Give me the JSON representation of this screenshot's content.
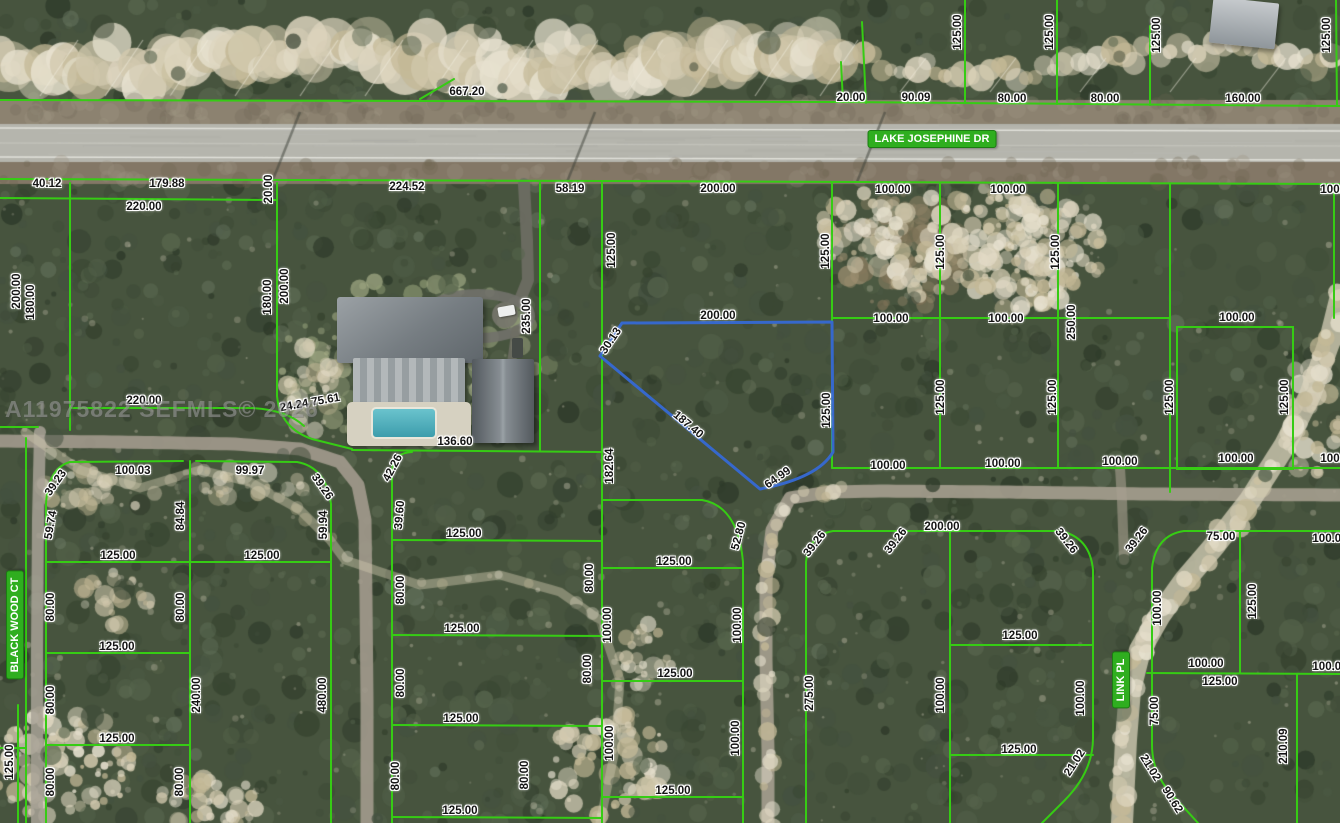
{
  "map": {
    "width": 1340,
    "height": 823,
    "description": "Aerial parcel map with lot dimension overlay",
    "watermark": {
      "text": "A11975822  SEFMLS© 2026"
    },
    "colors": {
      "parcel_line": "#36cc14",
      "highlight_parcel": "#3668cc",
      "street_label_bg": "#2fae1f",
      "street_label_text": "#ffffff",
      "dimension_text": "#141414"
    },
    "street_labels": [
      {
        "name": "LAKE JOSEPHINE DR",
        "x": 932,
        "y": 139,
        "r": 0
      },
      {
        "name": "BLACK WOOD CT",
        "x": 15,
        "y": 625,
        "r": -90
      },
      {
        "name": "LINK PL",
        "x": 1121,
        "y": 680,
        "r": -90
      }
    ],
    "highlighted_parcel": {
      "path": "M622,323 L832,322 L833,452 Q818,478 760,489 L600,356 Z",
      "dimensions": [
        "200.00",
        "125.00",
        "64.99",
        "187.40",
        "30.13"
      ]
    },
    "dimension_labels": [
      {
        "t": "667.20",
        "x": 467,
        "y": 92,
        "r": 0
      },
      {
        "t": "20.00",
        "x": 851,
        "y": 98,
        "r": 0
      },
      {
        "t": "90.09",
        "x": 916,
        "y": 98,
        "r": 0
      },
      {
        "t": "80.00",
        "x": 1012,
        "y": 99,
        "r": 0
      },
      {
        "t": "80.00",
        "x": 1105,
        "y": 99,
        "r": 0
      },
      {
        "t": "160.00",
        "x": 1243,
        "y": 99,
        "r": 0
      },
      {
        "t": "125.00",
        "x": 958,
        "y": 32,
        "r": -90
      },
      {
        "t": "125.00",
        "x": 1050,
        "y": 32,
        "r": -90
      },
      {
        "t": "125.00",
        "x": 1157,
        "y": 35,
        "r": -90
      },
      {
        "t": "125.00",
        "x": 1327,
        "y": 35,
        "r": -90
      },
      {
        "t": "40.12",
        "x": 47,
        "y": 184,
        "r": 0
      },
      {
        "t": "179.88",
        "x": 167,
        "y": 184,
        "r": 0
      },
      {
        "t": "224.52",
        "x": 407,
        "y": 187,
        "r": 0
      },
      {
        "t": "58.19",
        "x": 570,
        "y": 189,
        "r": 0
      },
      {
        "t": "200.00",
        "x": 718,
        "y": 189,
        "r": 0
      },
      {
        "t": "100.00",
        "x": 893,
        "y": 190,
        "r": 0
      },
      {
        "t": "100.00",
        "x": 1008,
        "y": 190,
        "r": 0
      },
      {
        "t": "100.00",
        "x": 1338,
        "y": 190,
        "r": 0
      },
      {
        "t": "220.00",
        "x": 144,
        "y": 207,
        "r": 0
      },
      {
        "t": "20.00",
        "x": 269,
        "y": 189,
        "r": -90
      },
      {
        "t": "200.00",
        "x": 17,
        "y": 291,
        "r": -90
      },
      {
        "t": "180.00",
        "x": 31,
        "y": 302,
        "r": -90
      },
      {
        "t": "180.00",
        "x": 268,
        "y": 297,
        "r": -90
      },
      {
        "t": "200.00",
        "x": 285,
        "y": 286,
        "r": -90
      },
      {
        "t": "235.00",
        "x": 527,
        "y": 316,
        "r": -90
      },
      {
        "t": "125.00",
        "x": 612,
        "y": 250,
        "r": -90
      },
      {
        "t": "125.00",
        "x": 826,
        "y": 251,
        "r": -90
      },
      {
        "t": "125.00",
        "x": 941,
        "y": 252,
        "r": -90
      },
      {
        "t": "125.00",
        "x": 1056,
        "y": 252,
        "r": -90
      },
      {
        "t": "200.00",
        "x": 718,
        "y": 316,
        "r": 0
      },
      {
        "t": "100.00",
        "x": 891,
        "y": 319,
        "r": 0
      },
      {
        "t": "100.00",
        "x": 1006,
        "y": 319,
        "r": 0
      },
      {
        "t": "100.00",
        "x": 1237,
        "y": 318,
        "r": 0
      },
      {
        "t": "250.00",
        "x": 1072,
        "y": 322,
        "r": -90
      },
      {
        "t": "30.13",
        "x": 611,
        "y": 341,
        "r": -56
      },
      {
        "t": "187.40",
        "x": 688,
        "y": 425,
        "r": 40
      },
      {
        "t": "64.99",
        "x": 778,
        "y": 478,
        "r": -35
      },
      {
        "t": "125.00",
        "x": 827,
        "y": 410,
        "r": -90
      },
      {
        "t": "125.00",
        "x": 941,
        "y": 397,
        "r": -90
      },
      {
        "t": "125.00",
        "x": 1053,
        "y": 397,
        "r": -90
      },
      {
        "t": "125.00",
        "x": 1170,
        "y": 397,
        "r": -90
      },
      {
        "t": "125.00",
        "x": 1285,
        "y": 397,
        "r": -90
      },
      {
        "t": "182.64",
        "x": 610,
        "y": 466,
        "r": -90
      },
      {
        "t": "220.00",
        "x": 144,
        "y": 401,
        "r": 0
      },
      {
        "t": "24.24 75.61",
        "x": 310,
        "y": 403,
        "r": -10
      },
      {
        "t": "136.60",
        "x": 455,
        "y": 442,
        "r": 0
      },
      {
        "t": "100.00",
        "x": 888,
        "y": 466,
        "r": 0
      },
      {
        "t": "100.00",
        "x": 1003,
        "y": 464,
        "r": 0
      },
      {
        "t": "100.00",
        "x": 1120,
        "y": 462,
        "r": 0
      },
      {
        "t": "100.00",
        "x": 1236,
        "y": 459,
        "r": 0
      },
      {
        "t": "100.00",
        "x": 1338,
        "y": 459,
        "r": 0
      },
      {
        "t": "100.03",
        "x": 133,
        "y": 471,
        "r": 0
      },
      {
        "t": "99.97",
        "x": 250,
        "y": 471,
        "r": 0
      },
      {
        "t": "39.23",
        "x": 56,
        "y": 483,
        "r": -55
      },
      {
        "t": "59.74",
        "x": 51,
        "y": 525,
        "r": -80
      },
      {
        "t": "84.84",
        "x": 181,
        "y": 516,
        "r": -90
      },
      {
        "t": "39.26",
        "x": 322,
        "y": 487,
        "r": 55
      },
      {
        "t": "59.94",
        "x": 324,
        "y": 525,
        "r": -90
      },
      {
        "t": "125.00",
        "x": 118,
        "y": 556,
        "r": 0
      },
      {
        "t": "125.00",
        "x": 262,
        "y": 556,
        "r": 0
      },
      {
        "t": "80.00",
        "x": 51,
        "y": 607,
        "r": -90
      },
      {
        "t": "80.00",
        "x": 181,
        "y": 607,
        "r": -90
      },
      {
        "t": "125.00",
        "x": 117,
        "y": 647,
        "r": 0
      },
      {
        "t": "80.00",
        "x": 51,
        "y": 700,
        "r": -90
      },
      {
        "t": "240.00",
        "x": 197,
        "y": 695,
        "r": -90
      },
      {
        "t": "480.00",
        "x": 323,
        "y": 695,
        "r": -90
      },
      {
        "t": "125.00",
        "x": 117,
        "y": 739,
        "r": 0
      },
      {
        "t": "80.00",
        "x": 51,
        "y": 782,
        "r": -90
      },
      {
        "t": "80.00",
        "x": 180,
        "y": 782,
        "r": -90
      },
      {
        "t": "125.00",
        "x": 10,
        "y": 762,
        "r": -90
      },
      {
        "t": "42.26",
        "x": 393,
        "y": 468,
        "r": -62
      },
      {
        "t": "39.60",
        "x": 400,
        "y": 515,
        "r": -85
      },
      {
        "t": "125.00",
        "x": 464,
        "y": 534,
        "r": 0
      },
      {
        "t": "80.00",
        "x": 401,
        "y": 590,
        "r": -90
      },
      {
        "t": "80.00",
        "x": 590,
        "y": 578,
        "r": -90
      },
      {
        "t": "125.00",
        "x": 462,
        "y": 629,
        "r": 0
      },
      {
        "t": "80.00",
        "x": 401,
        "y": 683,
        "r": -90
      },
      {
        "t": "80.00",
        "x": 588,
        "y": 669,
        "r": -90
      },
      {
        "t": "125.00",
        "x": 461,
        "y": 719,
        "r": 0
      },
      {
        "t": "80.00",
        "x": 396,
        "y": 776,
        "r": -90
      },
      {
        "t": "80.00",
        "x": 525,
        "y": 775,
        "r": -90
      },
      {
        "t": "125.00",
        "x": 460,
        "y": 811,
        "r": 0
      },
      {
        "t": "52.80",
        "x": 739,
        "y": 536,
        "r": -75
      },
      {
        "t": "125.00",
        "x": 674,
        "y": 562,
        "r": 0
      },
      {
        "t": "100.00",
        "x": 608,
        "y": 625,
        "r": -90
      },
      {
        "t": "100.00",
        "x": 738,
        "y": 625,
        "r": -90
      },
      {
        "t": "125.00",
        "x": 675,
        "y": 674,
        "r": 0
      },
      {
        "t": "100.00",
        "x": 610,
        "y": 743,
        "r": -90
      },
      {
        "t": "100.00",
        "x": 736,
        "y": 738,
        "r": -90
      },
      {
        "t": "125.00",
        "x": 673,
        "y": 791,
        "r": 0
      },
      {
        "t": "39.26",
        "x": 815,
        "y": 544,
        "r": -52
      },
      {
        "t": "39.26",
        "x": 896,
        "y": 541,
        "r": -52
      },
      {
        "t": "200.00",
        "x": 942,
        "y": 527,
        "r": 0
      },
      {
        "t": "275.00",
        "x": 810,
        "y": 693,
        "r": -90
      },
      {
        "t": "125.00",
        "x": 1020,
        "y": 636,
        "r": 0
      },
      {
        "t": "100.00",
        "x": 941,
        "y": 695,
        "r": -90
      },
      {
        "t": "100.00",
        "x": 1081,
        "y": 698,
        "r": -90
      },
      {
        "t": "125.00",
        "x": 1019,
        "y": 750,
        "r": 0
      },
      {
        "t": "39.26",
        "x": 1066,
        "y": 541,
        "r": 52
      },
      {
        "t": "39.26",
        "x": 1137,
        "y": 540,
        "r": -52
      },
      {
        "t": "75.00",
        "x": 1221,
        "y": 537,
        "r": 0
      },
      {
        "t": "100.00",
        "x": 1330,
        "y": 539,
        "r": 0
      },
      {
        "t": "100.00",
        "x": 1158,
        "y": 608,
        "r": -90
      },
      {
        "t": "125.00",
        "x": 1253,
        "y": 601,
        "r": -90
      },
      {
        "t": "100.00",
        "x": 1206,
        "y": 664,
        "r": 0
      },
      {
        "t": "100.00",
        "x": 1330,
        "y": 667,
        "r": 0
      },
      {
        "t": "125.00",
        "x": 1220,
        "y": 682,
        "r": 0
      },
      {
        "t": "75.00",
        "x": 1155,
        "y": 711,
        "r": -90
      },
      {
        "t": "210.09",
        "x": 1284,
        "y": 746,
        "r": -90
      },
      {
        "t": "21.02",
        "x": 1075,
        "y": 763,
        "r": -57
      },
      {
        "t": "21.02",
        "x": 1150,
        "y": 768,
        "r": 58
      },
      {
        "t": "90.62",
        "x": 1172,
        "y": 800,
        "r": 58
      }
    ],
    "parcel_lines": [
      "M0,100 L835,102 L1340,106",
      "M0,179 L600,181 L1340,184",
      "M841,62 L843,102",
      "M862,22 L866,103",
      "M965,0 L965,103",
      "M1057,0 L1057,104",
      "M1150,26 L1150,105",
      "M1336,0 L1337,106",
      "M420,99 L454,79",
      "M0,198 L277,200",
      "M70,183 L70,430",
      "M0,427 L38,427",
      "M70,408 L252,408 Q287,410 304,426",
      "M277,183 L277,396 Q280,428 312,439 L352,449",
      "M352,450 L602,452",
      "M540,183 L540,450",
      "M602,183 L602,823",
      "M832,183 L832,468",
      "M940,183 L940,468",
      "M1058,183 L1058,468",
      "M1170,183 L1170,492",
      "M1334,184 L1334,318",
      "M832,318 L1170,318",
      "M832,468 L1340,468",
      "M1177,327 L1293,327 L1293,469 L1177,469 Z",
      "M70,462 L183,461",
      "M70,462 Q48,468 46,504",
      "M196,461 L297,462",
      "M297,462 Q326,467 331,504",
      "M46,504 L46,823",
      "M190,461 L190,823",
      "M331,504 L331,823",
      "M46,562 L331,562",
      "M46,653 L190,653",
      "M46,745 L190,745",
      "M26,438 L26,823",
      "M0,748 L26,748",
      "M18,705 L18,823",
      "M392,470 L392,823",
      "M392,470 Q393,453 412,452",
      "M392,540 L602,541",
      "M392,635 L602,636",
      "M392,725 L602,726",
      "M392,817 L602,818",
      "M602,500 L702,500",
      "M702,500 Q738,506 743,562",
      "M743,562 L743,823",
      "M602,568 L743,568",
      "M602,681 L743,681",
      "M602,797 L743,797",
      "M806,562 L806,823",
      "M806,562 Q809,535 833,531",
      "M833,531 L1060,531",
      "M1060,531 Q1090,537 1093,570",
      "M1093,570 L1093,738 Q1093,772 1064,801 L1042,823",
      "M950,531 L950,823",
      "M950,645 L1093,645",
      "M950,755 L1093,755",
      "M1152,568 Q1156,535 1184,531",
      "M1184,531 L1340,531",
      "M1152,568 L1152,745 Q1152,777 1178,801 L1198,823",
      "M1147,673 L1340,674",
      "M1240,531 L1240,673",
      "M1297,674 L1297,823"
    ]
  }
}
